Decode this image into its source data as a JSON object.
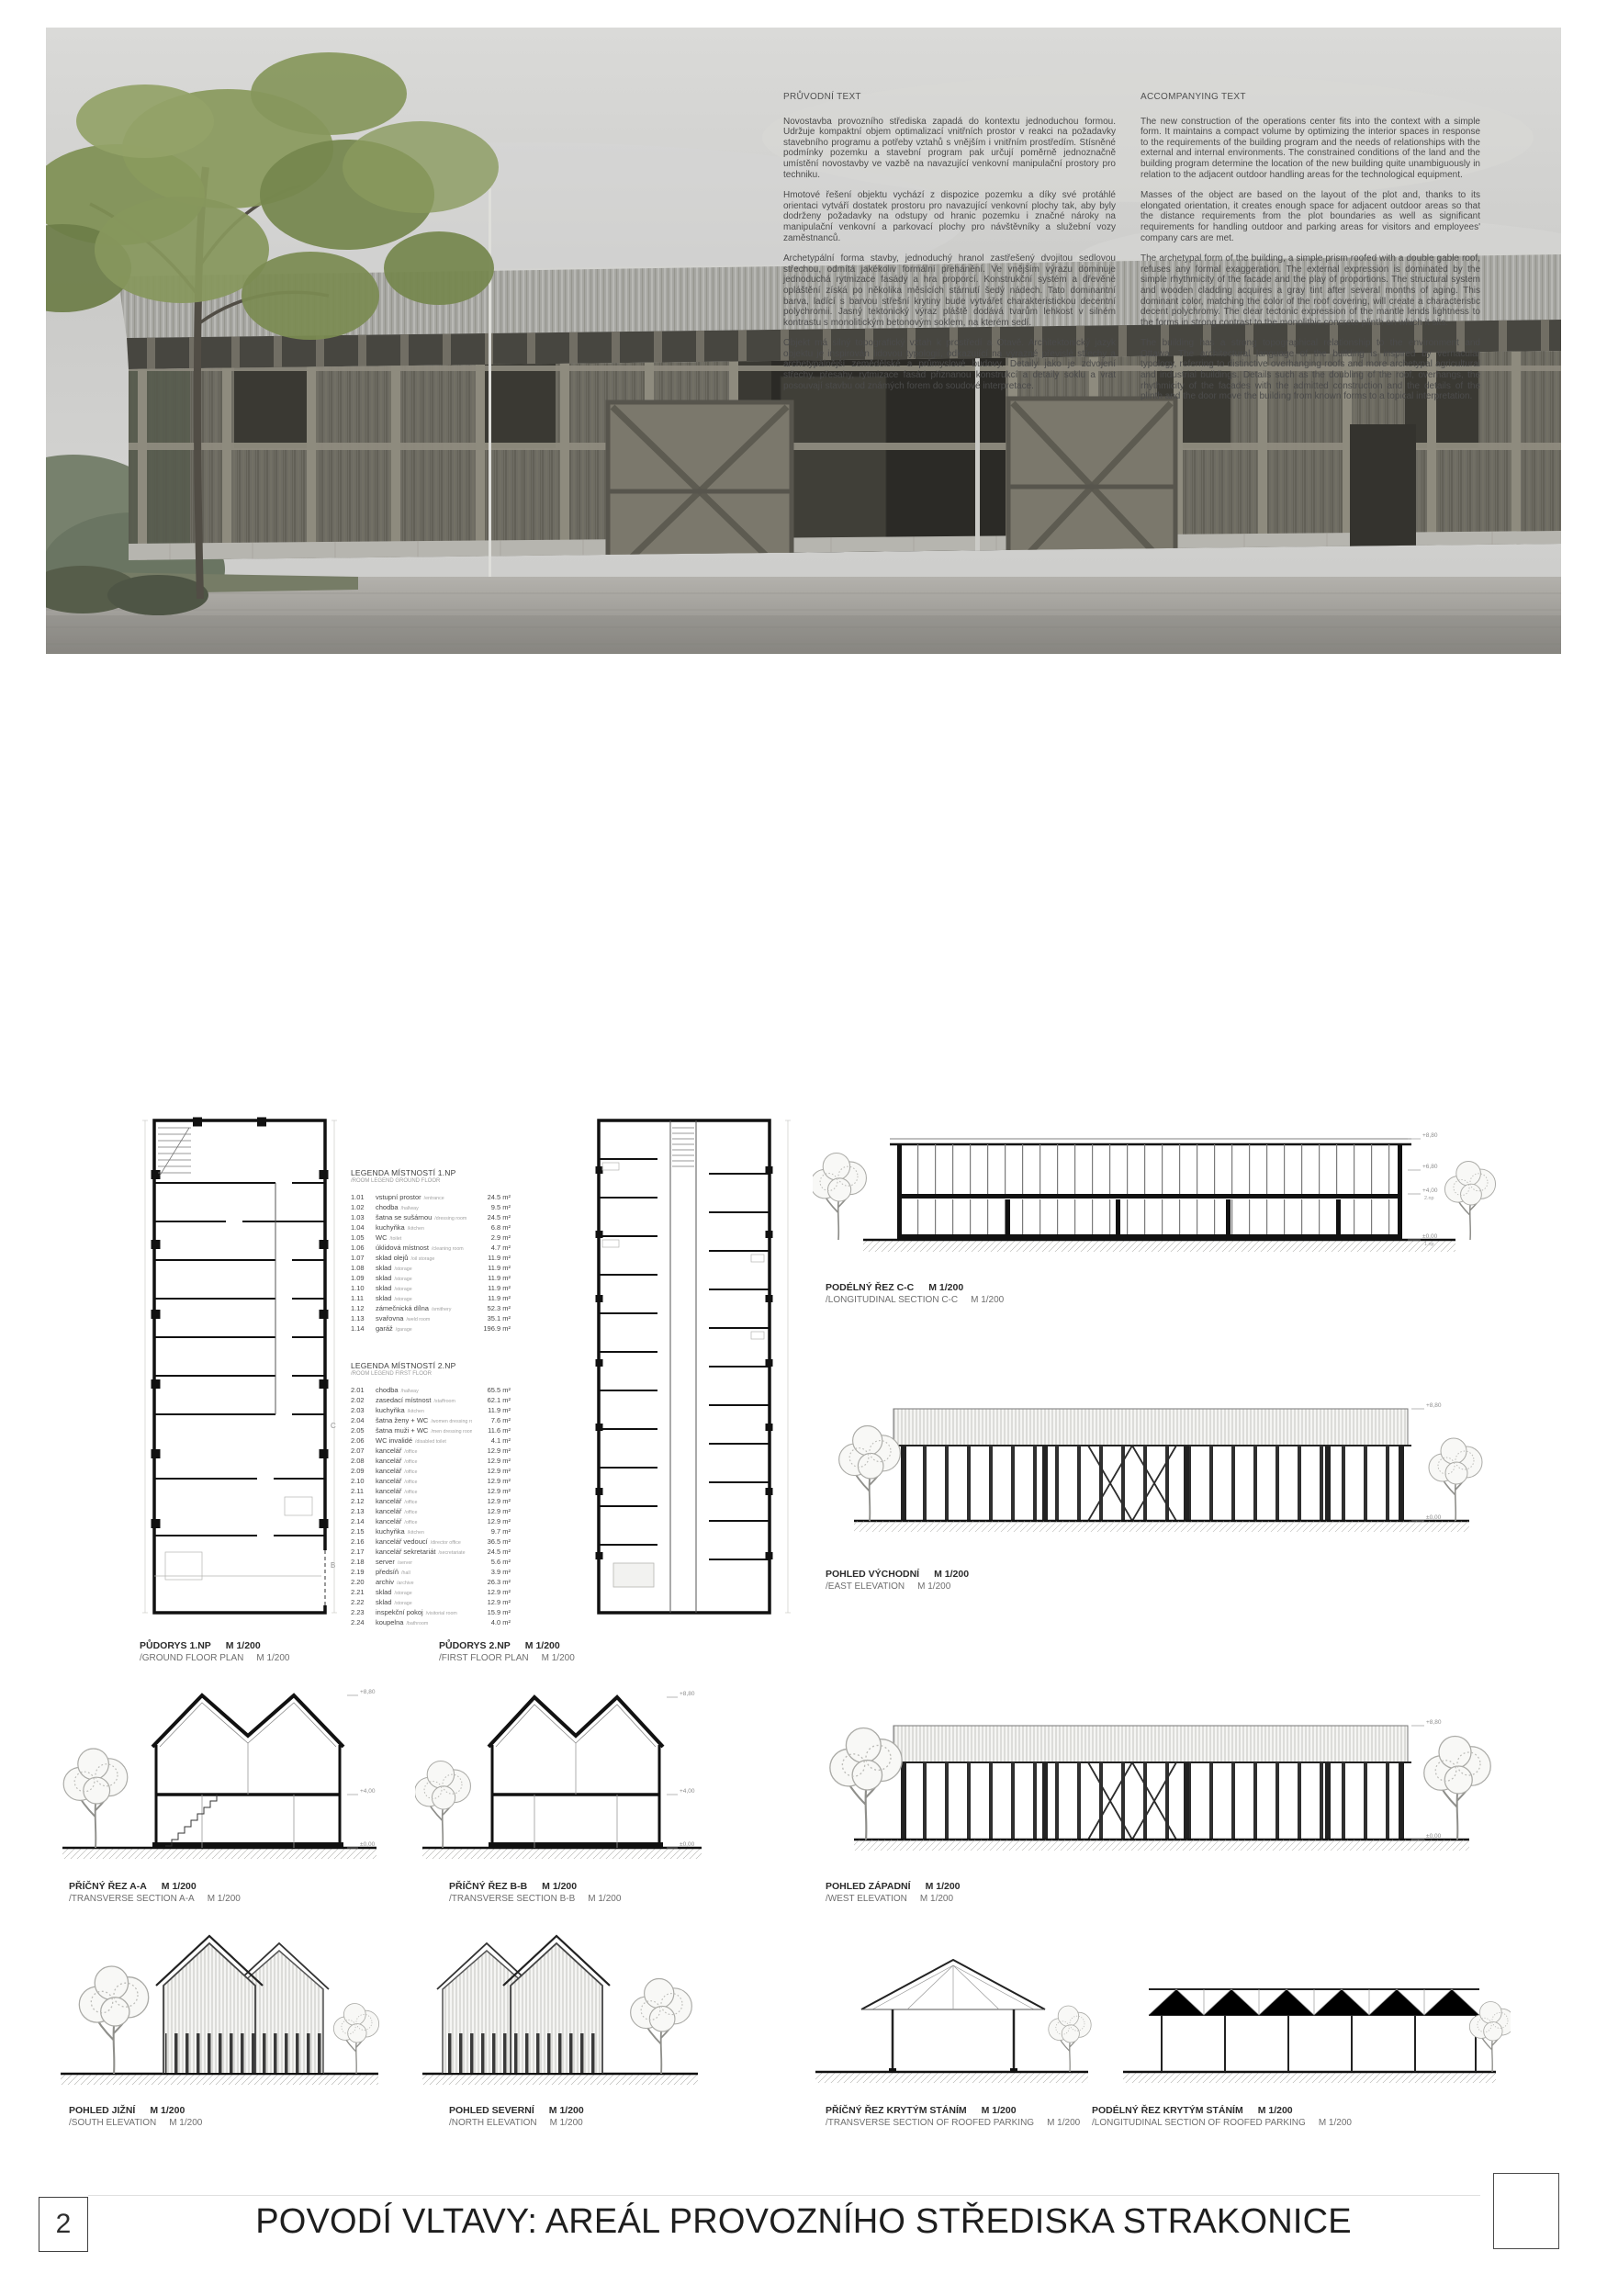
{
  "texts": {
    "cs": {
      "heading": "PRŮVODNÍ TEXT",
      "paragraphs": [
        "Novostavba provozního střediska zapadá do kontextu jednoduchou formou. Udržuje kompaktní objem optimalizací vnitřních prostor v reakci na požadavky stavebního programu a potřeby vztahů s vnějším i vnitřním prostředím. Stísněné podmínky pozemku a stavební program pak určují poměrně jednoznačně umístění novostavby ve vazbě na navazující venkovní manipulační prostory pro techniku.",
        "Hmotové řešení objektu vychází z dispozice pozemku a díky své protáhlé orientaci vytváří dostatek prostoru pro navazující venkovní plochy tak, aby byly dodrženy požadavky na odstupy od hranic pozemku i značné nároky na manipulační venkovní a parkovací plochy pro návštěvníky a služební vozy zaměstnanců.",
        "Archetypální forma stavby, jednoduchý hranol zastřešený dvojitou sedlovou střechou, odmítá jakékoliv formální přehánění. Ve vnějším výrazu dominuje jednoduchá rytmizace fasády a hra proporcí. Konstrukční systém a dřevěné opláštění získá po několika měsících stárnutí šedý nádech. Tato dominantní barva, ladící s barvou střešní krytiny bude vytvářet charakteristickou decentní polychromii. Jasný tektonický výraz pláště dodává tvarům lehkost v silném kontrastu s monolitickým betonovým soklem, na kterém sedí.",
        "Objekt má silný topografický vztah k prostředí a Otavě. Architektonický jazyk objektu je inspirován lidovou typologií, odkazující na výrazné převislé střechy a archetypálnější zemědělské a průmyslové budovy. Detaily jako je zdvojení střechy, přesahy, rytmizace fasád přiznanou konstrukcí a detaily soklu a vrat posouvají stavbu od známých forem do soudové interpretace."
      ]
    },
    "en": {
      "heading": "ACCOMPANYING TEXT",
      "paragraphs": [
        "The new construction of the operations center fits into the context with a simple form. It maintains a compact volume by optimizing the interior spaces in response to the requirements of the building program and the needs of relationships with the external and internal environments. The constrained conditions of the land and the building program determine the location of the new building quite unambiguously in relation to the adjacent outdoor handling areas for the technological equipment.",
        "Masses of the object are based on the layout of the plot and, thanks to its elongated orientation, it creates enough space for adjacent outdoor areas so that the distance requirements from the plot boundaries as well as significant requirements for handling outdoor and parking areas for visitors and employees' company cars are met.",
        "The archetypal form of the building, a simple prism roofed with a double gable roof, refuses any formal exaggeration. The external expression is dominated by the simple rhythmicity of the facade and the play of proportions. The structural system and wooden cladding acquires a gray tint after several months of aging. This dominant color, matching the color of the roof covering, will create a characteristic decent polychromy. The clear tectonic expression of the mantle lends lightness to the forms in strong contrast to the monolithic concrete plinth on which it sits.",
        "The building has a strong topographical relationship to the environment and Ottawa. The architectural language of the building is inspired by vernacular typology, referring to distinctive overhanging roofs and more archetypal agricultural and industrial buildings. Details such as the doubling of the roof, overhangs, the rhythmicity of the facades with the admitted construction and the details of the plinth and the door move the building from known forms to a topical interpretation."
      ]
    }
  },
  "legend1": {
    "title": "LEGENDA MÍSTNOSTÍ 1.NP",
    "subtitle": "/ROOM LEGEND GROUND FLOOR",
    "rows": [
      {
        "num": "1.01",
        "name": "vstupní prostor",
        "sub": "/entrance",
        "area": "24.5 m²"
      },
      {
        "num": "1.02",
        "name": "chodba",
        "sub": "/hallway",
        "area": "9.5 m²"
      },
      {
        "num": "1.03",
        "name": "šatna se sušárnou",
        "sub": "/dressing room",
        "area": "24.5 m²"
      },
      {
        "num": "1.04",
        "name": "kuchyňka",
        "sub": "/kitchen",
        "area": "6.8 m²"
      },
      {
        "num": "1.05",
        "name": "WC",
        "sub": "/toilet",
        "area": "2.9 m²"
      },
      {
        "num": "1.06",
        "name": "úklidová místnost",
        "sub": "/cleaning room",
        "area": "4.7 m²"
      },
      {
        "num": "1.07",
        "name": "sklad olejů",
        "sub": "/oil storage",
        "area": "11.9 m²"
      },
      {
        "num": "1.08",
        "name": "sklad",
        "sub": "/storage",
        "area": "11.9 m²"
      },
      {
        "num": "1.09",
        "name": "sklad",
        "sub": "/storage",
        "area": "11.9 m²"
      },
      {
        "num": "1.10",
        "name": "sklad",
        "sub": "/storage",
        "area": "11.9 m²"
      },
      {
        "num": "1.11",
        "name": "sklad",
        "sub": "/storage",
        "area": "11.9 m²"
      },
      {
        "num": "1.12",
        "name": "zámečnická dílna",
        "sub": "/smithery",
        "area": "52.3 m²"
      },
      {
        "num": "1.13",
        "name": "svařovna",
        "sub": "/weld room",
        "area": "35.1 m²"
      },
      {
        "num": "1.14",
        "name": "garáž",
        "sub": "/garage",
        "area": "196.9 m²"
      }
    ]
  },
  "legend2": {
    "title": "LEGENDA MÍSTNOSTÍ 2.NP",
    "subtitle": "/ROOM LEGEND FIRST FLOOR",
    "rows": [
      {
        "num": "2.01",
        "name": "chodba",
        "sub": "/hallway",
        "area": "65.5 m²"
      },
      {
        "num": "2.02",
        "name": "zasedací místnost",
        "sub": "/staffroom",
        "area": "62.1 m²"
      },
      {
        "num": "2.03",
        "name": "kuchyňka",
        "sub": "/kitchen",
        "area": "11.9 m²"
      },
      {
        "num": "2.04",
        "name": "šatna ženy + WC",
        "sub": "/women dressing room + toilet",
        "area": "7.6 m²"
      },
      {
        "num": "2.05",
        "name": "šatna muži + WC",
        "sub": "/men dressing room + toilet",
        "area": "11.6 m²"
      },
      {
        "num": "2.06",
        "name": "WC invalidé",
        "sub": "/disabled toilet",
        "area": "4.1 m²"
      },
      {
        "num": "2.07",
        "name": "kancelář",
        "sub": "/office",
        "area": "12.9 m²"
      },
      {
        "num": "2.08",
        "name": "kancelář",
        "sub": "/office",
        "area": "12.9 m²"
      },
      {
        "num": "2.09",
        "name": "kancelář",
        "sub": "/office",
        "area": "12.9 m²"
      },
      {
        "num": "2.10",
        "name": "kancelář",
        "sub": "/office",
        "area": "12.9 m²"
      },
      {
        "num": "2.11",
        "name": "kancelář",
        "sub": "/office",
        "area": "12.9 m²"
      },
      {
        "num": "2.12",
        "name": "kancelář",
        "sub": "/office",
        "area": "12.9 m²"
      },
      {
        "num": "2.13",
        "name": "kancelář",
        "sub": "/office",
        "area": "12.9 m²"
      },
      {
        "num": "2.14",
        "name": "kancelář",
        "sub": "/office",
        "area": "12.9 m²"
      },
      {
        "num": "2.15",
        "name": "kuchyňka",
        "sub": "/kitchen",
        "area": "9.7 m²"
      },
      {
        "num": "2.16",
        "name": "kancelář vedoucí",
        "sub": "/director office",
        "area": "36.5 m²"
      },
      {
        "num": "2.17",
        "name": "kancelář sekretariát",
        "sub": "/secretariate",
        "area": "24.5 m²"
      },
      {
        "num": "2.18",
        "name": "server",
        "sub": "/server",
        "area": "5.6 m²"
      },
      {
        "num": "2.19",
        "name": "předsíň",
        "sub": "/hall",
        "area": "3.9 m²"
      },
      {
        "num": "2.20",
        "name": "archiv",
        "sub": "/archive",
        "area": "26.3 m²"
      },
      {
        "num": "2.21",
        "name": "sklad",
        "sub": "/storage",
        "area": "12.9 m²"
      },
      {
        "num": "2.22",
        "name": "sklad",
        "sub": "/storage",
        "area": "12.9 m²"
      },
      {
        "num": "2.23",
        "name": "inspekční pokoj",
        "sub": "/visitorial room",
        "area": "15.9 m²"
      },
      {
        "num": "2.24",
        "name": "koupelna",
        "sub": "/bathroom",
        "area": "4.0 m²"
      }
    ]
  },
  "drawings": {
    "plan1": {
      "t": "PŮDORYS 1.NP",
      "s": "M 1/200",
      "te": "/GROUND FLOOR PLAN",
      "se": "M 1/200"
    },
    "plan2": {
      "t": "PŮDORYS 2.NP",
      "s": "M 1/200",
      "te": "/FIRST FLOOR PLAN",
      "se": "M 1/200"
    },
    "cc": {
      "t": "PODÉLNÝ ŘEZ C-C",
      "s": "M 1/200",
      "te": "/LONGITUDINAL SECTION C-C",
      "se": "M 1/200"
    },
    "east": {
      "t": "POHLED VÝCHODNÍ",
      "s": "M 1/200",
      "te": "/EAST ELEVATION",
      "se": "M 1/200"
    },
    "west": {
      "t": "POHLED ZÁPADNÍ",
      "s": "M 1/200",
      "te": "/WEST ELEVATION",
      "se": "M 1/200"
    },
    "aa": {
      "t": "PŘÍČNÝ ŘEZ A-A",
      "s": "M 1/200",
      "te": "/TRANSVERSE SECTION A-A",
      "se": "M 1/200"
    },
    "bb": {
      "t": "PŘÍČNÝ ŘEZ B-B",
      "s": "M 1/200",
      "te": "/TRANSVERSE SECTION B-B",
      "se": "M 1/200"
    },
    "south": {
      "t": "POHLED JIŽNÍ",
      "s": "M 1/200",
      "te": "/SOUTH ELEVATION",
      "se": "M 1/200"
    },
    "north": {
      "t": "POHLED SEVERNÍ",
      "s": "M 1/200",
      "te": "/NORTH ELEVATION",
      "se": "M 1/200"
    },
    "parking_t": {
      "t": "PŘÍČNÝ ŘEZ KRYTÝM STÁNÍM",
      "s": "M 1/200",
      "te": "/TRANSVERSE SECTION OF ROOFED PARKING",
      "se": "M 1/200"
    },
    "parking_l": {
      "t": "PODÉLNÝ ŘEZ KRYTÝM STÁNÍM",
      "s": "M 1/200",
      "te": "/LONGITUDINAL SECTION OF ROOFED PARKING",
      "se": "M 1/200"
    }
  },
  "levels": {
    "top": "+8,80",
    "mid": "+6,80",
    "floor2": "+4,00",
    "zero": "±0,00",
    "f2": "2.np",
    "f1": "1.np"
  },
  "section_markers": {
    "c": "C",
    "b": "B"
  },
  "footer": {
    "page_number": "2",
    "title": "POVODÍ VLTAVY: AREÁL PROVOZNÍHO STŘEDISKA STRAKONICE"
  },
  "colors": {
    "facade_wood": "#6e6c63",
    "roof": "#a7a7a3",
    "plinth_concrete": "#b6b5af",
    "sky": "#d2d2d0",
    "foliage": "#87975c",
    "drawing_ink": "#111111",
    "drawing_gray": "#9a9a96"
  }
}
